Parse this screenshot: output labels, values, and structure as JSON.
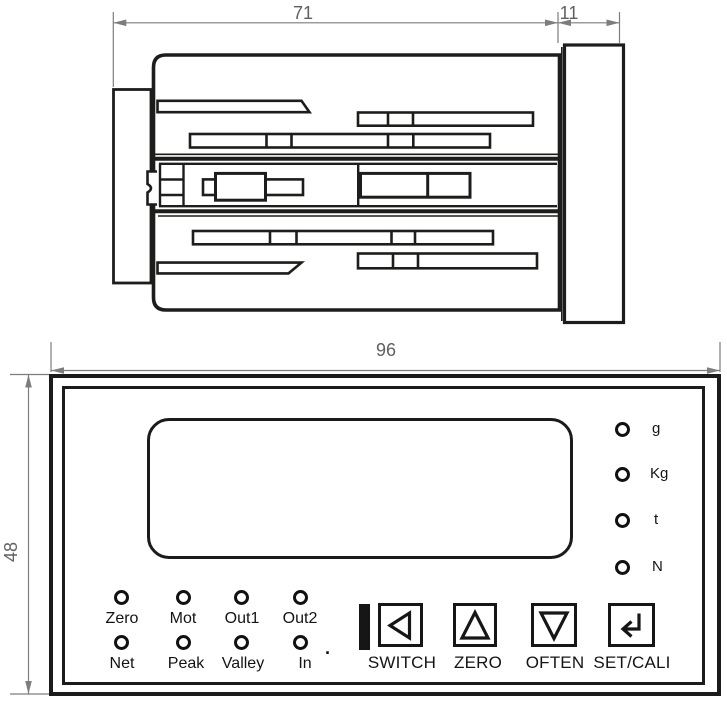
{
  "side_view": {
    "depth_dim": "71",
    "bezel_dim": "11"
  },
  "front_view": {
    "width_dim": "96",
    "height_dim": "48",
    "unit_leds": [
      {
        "label": "g"
      },
      {
        "label": "Kg"
      },
      {
        "label": "t"
      },
      {
        "label": "N"
      }
    ],
    "status_leds": {
      "row1": [
        {
          "label": "Zero"
        },
        {
          "label": "Mot"
        },
        {
          "label": "Out1"
        },
        {
          "label": "Out2"
        }
      ],
      "row2": [
        {
          "label": "Net"
        },
        {
          "label": "Peak"
        },
        {
          "label": "Valley"
        },
        {
          "label": "In"
        }
      ],
      "dot": "."
    },
    "buttons": [
      {
        "label": "SWITCH",
        "icon": "triangle-left"
      },
      {
        "label": "ZERO",
        "icon": "triangle-up"
      },
      {
        "label": "OFTEN",
        "icon": "triangle-down"
      },
      {
        "label": "SET/CALI",
        "icon": "enter-arrow"
      }
    ]
  },
  "colors": {
    "line": "#1d1d1b",
    "dim": "#7d7d7d"
  }
}
